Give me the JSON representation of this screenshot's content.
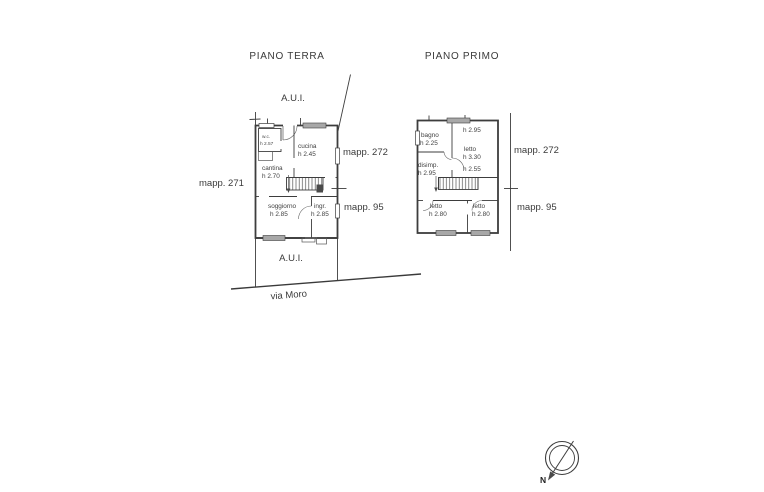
{
  "page": {
    "background": "#ffffff",
    "ink": "#3d3d3d",
    "text_color": "#3a3a3a",
    "window_fill": "#a8a8a8"
  },
  "titles": {
    "ground_floor": "PIANO TERRA",
    "first_floor": "PIANO PRIMO"
  },
  "site": {
    "aui_top": "A.U.I.",
    "aui_bottom": "A.U.I.",
    "street": "via Moro",
    "mapp_left": "mapp. 271",
    "ground_right_top": "mapp. 272",
    "ground_right_bottom": "mapp. 95",
    "first_right_top": "mapp. 272",
    "first_right_bottom": "mapp. 95"
  },
  "compass": {
    "north_label": "N"
  },
  "ground_floor": {
    "rooms": {
      "wc": {
        "name": "w.c.",
        "height": "h 2.57"
      },
      "cucina": {
        "name": "cucina",
        "height": "h 2.45"
      },
      "cantina": {
        "name": "cantina",
        "height": "h 2.70"
      },
      "soggiorno": {
        "name": "soggiorno",
        "height": "h 2.85"
      },
      "ingresso": {
        "name": "ingr.",
        "height": "h 2.85"
      }
    }
  },
  "first_floor": {
    "rooms": {
      "bagno": {
        "name": "bagno",
        "height": "h 2.25"
      },
      "letto_grande": {
        "name": "letto",
        "height": "h 3.30",
        "height_top": "h 2.95",
        "height_bottom": "h 2.55"
      },
      "disimpegno": {
        "name": "disimp.",
        "height": "h 2.95"
      },
      "letto_sx": {
        "name": "letto",
        "height": "h 2.80"
      },
      "letto_dx": {
        "name": "letto",
        "height": "h 2.80"
      }
    }
  }
}
